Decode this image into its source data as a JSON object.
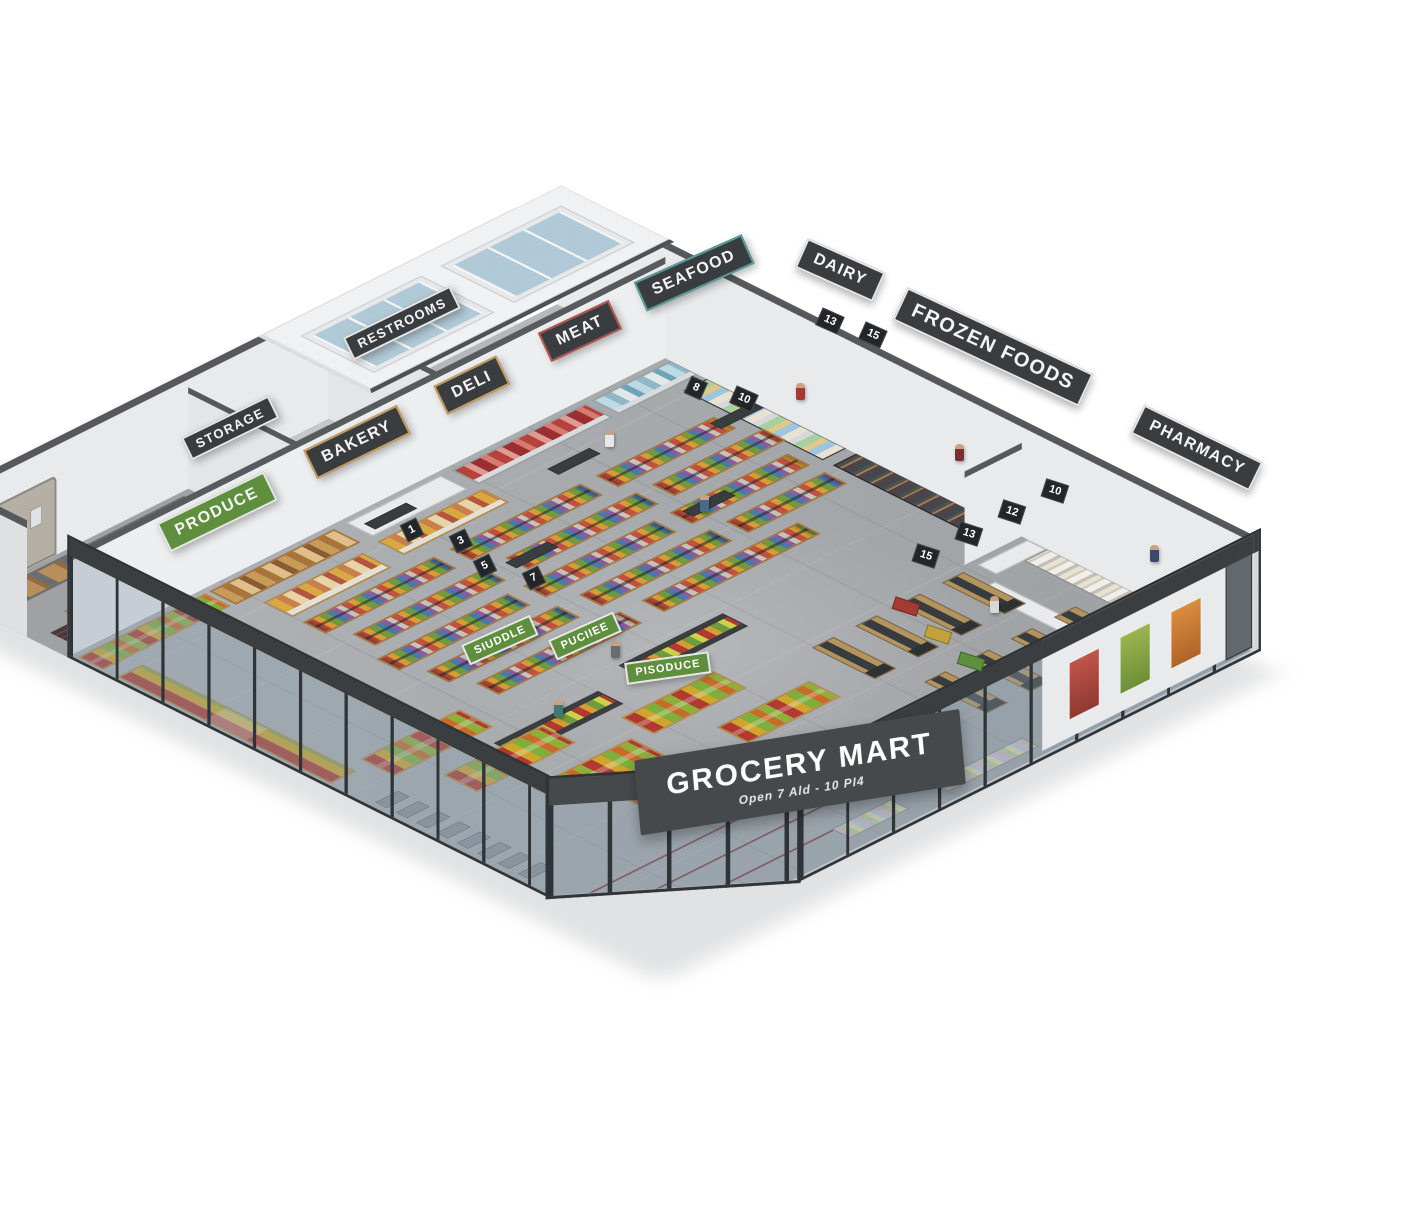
{
  "building": {
    "name": "GROCERY MART",
    "tagline": "Open 7 Ald - 10 PI4"
  },
  "department_signs": {
    "storage": "STORAGE",
    "restrooms": "RESTROOMS",
    "produce": "PRODUCE",
    "bakery": "BAKERY",
    "deli": "DELI",
    "meat": "MEAT",
    "seafood": "SEAFOOD",
    "dairy": "DAIRY",
    "frozen_foods": "FROZEN FOODS",
    "pharmacy": "PHARMACY"
  },
  "produce_area_signs": [
    "SIUDDLE",
    "PUCIIEE",
    "PISODUCE"
  ],
  "aisle_numbers": [
    "1",
    "3",
    "5",
    "7",
    "8",
    "10",
    "13",
    "15"
  ],
  "checkout_lanes": [
    "15",
    "13",
    "12",
    "10"
  ],
  "colors": {
    "produce_green": "#5f8f3e",
    "meat_red": "#b05454",
    "seafood_teal": "#5a9a9a",
    "bakery_deli_gold": "#c79c5e",
    "sign_charcoal": "#3a3d3f",
    "storefront_fascia": "#46494b",
    "floor_concrete": "#a9acaf"
  }
}
